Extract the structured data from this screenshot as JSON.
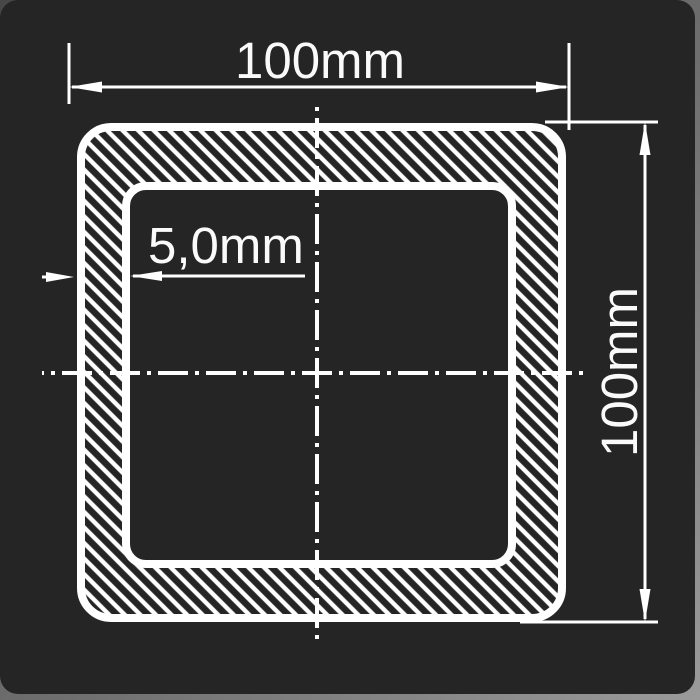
{
  "drawing": {
    "type": "technical-cross-section",
    "subject": "square hollow section profile",
    "dimensions": {
      "width_label": "100mm",
      "height_label": "100mm",
      "thickness_label": "5,0mm"
    },
    "colors": {
      "background": "#252525",
      "line": "#ffffff",
      "frame_edge": "#8a8a8a"
    }
  }
}
